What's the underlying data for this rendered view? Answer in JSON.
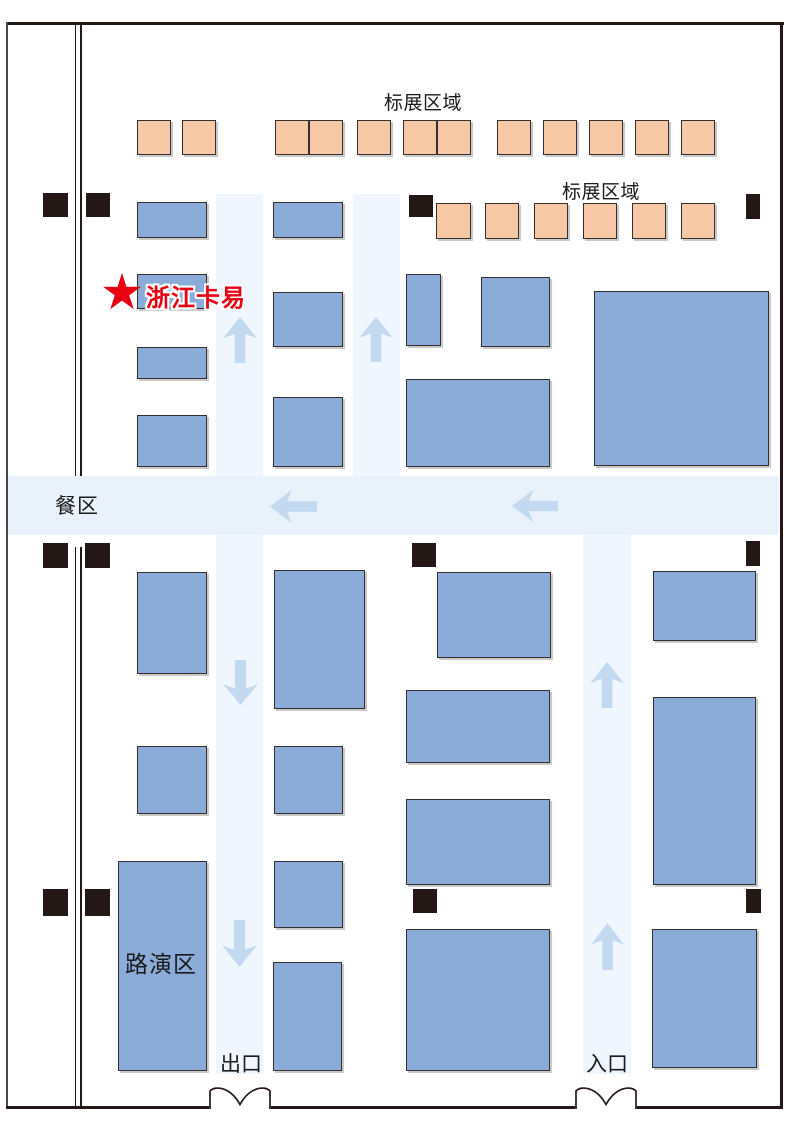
{
  "labels": {
    "standard_area_top": "标展区域",
    "standard_area_right": "标展区域",
    "dining_area": "餐区",
    "roadshow_area": "路演区",
    "exit": "出口",
    "entrance": "入口",
    "highlight_booth": "浙江卡易"
  },
  "colors": {
    "booth_blue": "#8BACD8",
    "booth_orange": "#F6C8A6",
    "booth_border": "#35302B",
    "corridor_blue": "#F0F6FD",
    "band_blue": "#E9F1FA",
    "arrow_blue": "#C3D9F0",
    "pillar_black": "#231815",
    "wall_black": "#231815",
    "highlight_red": "#E60012",
    "label_black": "#1A1A1A"
  },
  "map": {
    "corridors": [
      {
        "x": 216,
        "y": 194,
        "w": 47,
        "h": 880
      },
      {
        "x": 353,
        "y": 194,
        "w": 47,
        "h": 282
      },
      {
        "x": 583,
        "y": 535,
        "w": 48,
        "h": 539
      },
      {
        "x": 7,
        "y": 476,
        "w": 772,
        "h": 59,
        "band": true
      }
    ],
    "arrows": [
      {
        "dir": "up",
        "x": 223,
        "y": 317,
        "w": 34,
        "h": 46
      },
      {
        "dir": "up",
        "x": 359,
        "y": 317,
        "w": 34,
        "h": 45
      },
      {
        "dir": "left",
        "x": 270,
        "y": 490,
        "w": 47,
        "h": 33
      },
      {
        "dir": "left",
        "x": 512,
        "y": 490,
        "w": 46,
        "h": 32
      },
      {
        "dir": "down",
        "x": 223,
        "y": 660,
        "w": 35,
        "h": 45
      },
      {
        "dir": "up",
        "x": 590,
        "y": 662,
        "w": 34,
        "h": 46
      },
      {
        "dir": "down",
        "x": 222,
        "y": 920,
        "w": 35,
        "h": 47
      },
      {
        "dir": "up",
        "x": 591,
        "y": 923,
        "w": 33,
        "h": 47
      }
    ],
    "booths_standard": [
      {
        "x": 137,
        "y": 120,
        "w": 34,
        "h": 35
      },
      {
        "x": 182,
        "y": 120,
        "w": 34,
        "h": 35
      },
      {
        "x": 275,
        "y": 120,
        "w": 34,
        "h": 35
      },
      {
        "x": 309,
        "y": 120,
        "w": 34,
        "h": 35
      },
      {
        "x": 357,
        "y": 120,
        "w": 34,
        "h": 35
      },
      {
        "x": 403,
        "y": 120,
        "w": 34,
        "h": 35
      },
      {
        "x": 437,
        "y": 120,
        "w": 34,
        "h": 35
      },
      {
        "x": 497,
        "y": 120,
        "w": 34,
        "h": 35
      },
      {
        "x": 543,
        "y": 120,
        "w": 34,
        "h": 35
      },
      {
        "x": 589,
        "y": 120,
        "w": 34,
        "h": 35
      },
      {
        "x": 635,
        "y": 120,
        "w": 34,
        "h": 35
      },
      {
        "x": 681,
        "y": 120,
        "w": 34,
        "h": 35
      },
      {
        "x": 436,
        "y": 203,
        "w": 35,
        "h": 36
      },
      {
        "x": 485,
        "y": 203,
        "w": 34,
        "h": 36
      },
      {
        "x": 534,
        "y": 203,
        "w": 34,
        "h": 36
      },
      {
        "x": 583,
        "y": 203,
        "w": 34,
        "h": 36
      },
      {
        "x": 632,
        "y": 203,
        "w": 34,
        "h": 36
      },
      {
        "x": 681,
        "y": 203,
        "w": 34,
        "h": 36
      }
    ],
    "booths_blue": [
      {
        "x": 137,
        "y": 202,
        "w": 70,
        "h": 36
      },
      {
        "x": 273,
        "y": 202,
        "w": 70,
        "h": 36
      },
      {
        "x": 137,
        "y": 274,
        "w": 70,
        "h": 35,
        "highlight": true
      },
      {
        "x": 137,
        "y": 347,
        "w": 70,
        "h": 32
      },
      {
        "x": 273,
        "y": 292,
        "w": 70,
        "h": 55
      },
      {
        "x": 406,
        "y": 274,
        "w": 35,
        "h": 72
      },
      {
        "x": 481,
        "y": 277,
        "w": 69,
        "h": 70
      },
      {
        "x": 594,
        "y": 291,
        "w": 175,
        "h": 175
      },
      {
        "x": 137,
        "y": 415,
        "w": 70,
        "h": 52
      },
      {
        "x": 273,
        "y": 397,
        "w": 70,
        "h": 70
      },
      {
        "x": 406,
        "y": 379,
        "w": 144,
        "h": 88
      },
      {
        "x": 137,
        "y": 572,
        "w": 70,
        "h": 102
      },
      {
        "x": 274,
        "y": 570,
        "w": 91,
        "h": 139
      },
      {
        "x": 437,
        "y": 572,
        "w": 114,
        "h": 86
      },
      {
        "x": 653,
        "y": 571,
        "w": 103,
        "h": 70
      },
      {
        "x": 137,
        "y": 746,
        "w": 70,
        "h": 68
      },
      {
        "x": 274,
        "y": 746,
        "w": 69,
        "h": 68
      },
      {
        "x": 406,
        "y": 690,
        "w": 144,
        "h": 73
      },
      {
        "x": 653,
        "y": 697,
        "w": 103,
        "h": 188
      },
      {
        "x": 406,
        "y": 799,
        "w": 144,
        "h": 86
      },
      {
        "x": 274,
        "y": 861,
        "w": 69,
        "h": 67
      },
      {
        "x": 118,
        "y": 861,
        "w": 89,
        "h": 210,
        "roadshow": true
      },
      {
        "x": 273,
        "y": 962,
        "w": 69,
        "h": 109
      },
      {
        "x": 406,
        "y": 929,
        "w": 144,
        "h": 142
      },
      {
        "x": 652,
        "y": 929,
        "w": 105,
        "h": 139
      }
    ],
    "pillars": [
      {
        "x": 43,
        "y": 193,
        "w": 25,
        "h": 24
      },
      {
        "x": 86,
        "y": 193,
        "w": 24,
        "h": 24
      },
      {
        "x": 409,
        "y": 195,
        "w": 24,
        "h": 22
      },
      {
        "x": 746,
        "y": 194,
        "w": 14,
        "h": 25
      },
      {
        "x": 43,
        "y": 543,
        "w": 25,
        "h": 25
      },
      {
        "x": 85,
        "y": 543,
        "w": 25,
        "h": 25
      },
      {
        "x": 412,
        "y": 543,
        "w": 24,
        "h": 24
      },
      {
        "x": 746,
        "y": 541,
        "w": 14,
        "h": 25
      },
      {
        "x": 43,
        "y": 889,
        "w": 25,
        "h": 27
      },
      {
        "x": 85,
        "y": 889,
        "w": 25,
        "h": 27
      },
      {
        "x": 413,
        "y": 889,
        "w": 24,
        "h": 24
      },
      {
        "x": 746,
        "y": 889,
        "w": 15,
        "h": 24
      }
    ],
    "doors": [
      {
        "x": 205,
        "y": 1084,
        "label": "exit"
      },
      {
        "x": 571,
        "y": 1084,
        "label": "entrance"
      }
    ]
  }
}
